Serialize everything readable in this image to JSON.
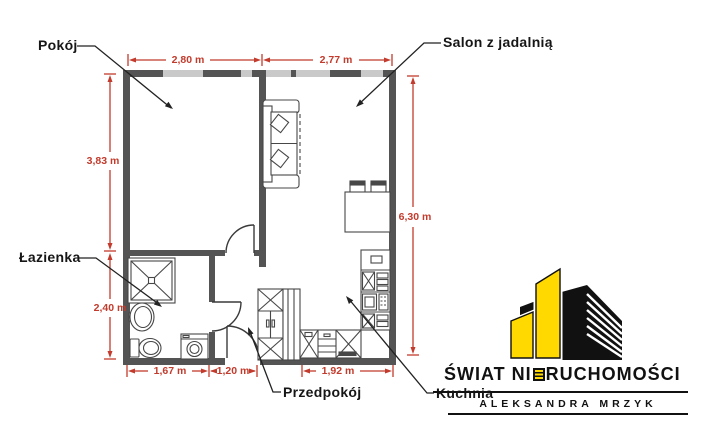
{
  "floor_plan": {
    "rooms": {
      "pokoj": "Pokój",
      "salon": "Salon z jadalnią",
      "lazienka": "Łazienka",
      "przedpokoj": "Przedpokój",
      "kuchnia": "Kuchnia"
    },
    "dimensions": {
      "top_left": "2,80 m",
      "top_right": "2,77 m",
      "left_upper": "3,83 m",
      "left_lower": "2,40 m",
      "right_side": "6,30 m",
      "bottom_left": "1,67 m",
      "bottom_middle": "1,20 m",
      "bottom_right": "1,92 m"
    },
    "colors": {
      "wall": "#545454",
      "window": "#c9c9c9",
      "dimension_red": "#c23b2c"
    }
  },
  "logo": {
    "brand_full": "ŚWIAT NIERUCHOMOŚCI",
    "brand_part1": "ŚWIAT NI",
    "brand_stylized_letter": "E",
    "brand_part2": "RUCHOMOŚCI",
    "agent_name": "ALEKSANDRA MRZYK",
    "colors": {
      "yellow": "#ffd900",
      "black": "#111111"
    }
  }
}
